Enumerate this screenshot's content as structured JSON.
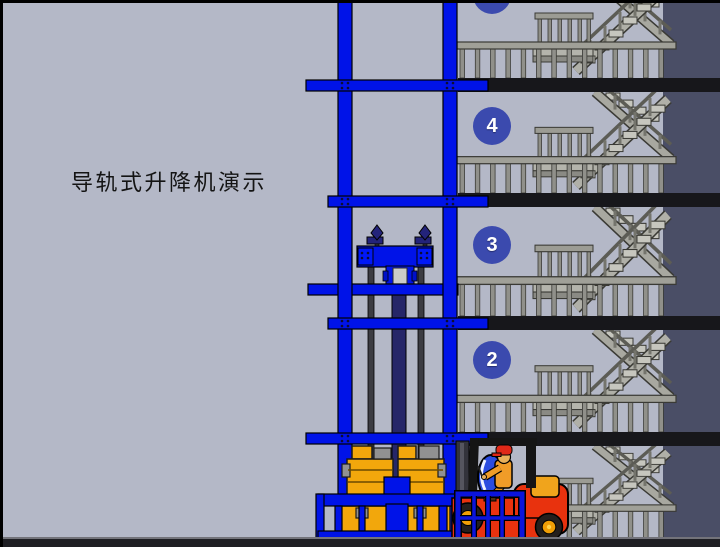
{
  "title": {
    "text": "导轨式升降机演示"
  },
  "building": {
    "floor_badges": [
      "5",
      "4",
      "3",
      "2"
    ],
    "floors": [
      {
        "label": "5",
        "unit_top": -22,
        "unit_height": 100,
        "circle_top": -24,
        "has_circle": true
      },
      {
        "label": "4",
        "unit_top": 92,
        "unit_height": 101,
        "circle_top": 107,
        "has_circle": true
      },
      {
        "label": "3",
        "unit_top": 207,
        "unit_height": 109,
        "circle_top": 226,
        "has_circle": true
      },
      {
        "label": "2",
        "unit_top": 330,
        "unit_height": 102,
        "circle_top": 341,
        "has_circle": true
      },
      {
        "unit_top": 446,
        "unit_height": 92,
        "has_circle": false
      }
    ],
    "slab_tops": [
      78,
      193,
      316,
      432
    ]
  },
  "colors": {
    "background": "#b4b8c7",
    "wall_dark": "#4a4e66",
    "floor_slab": "#17171b",
    "guide_rail_blue": "#0013e8",
    "floor_badge_blue": "#3b4aae",
    "cylinder_navy": "#262668",
    "cargo_orange": "#f2a70c",
    "forklift_red": "#e8320e",
    "steel_gray": "#9a9a92"
  }
}
